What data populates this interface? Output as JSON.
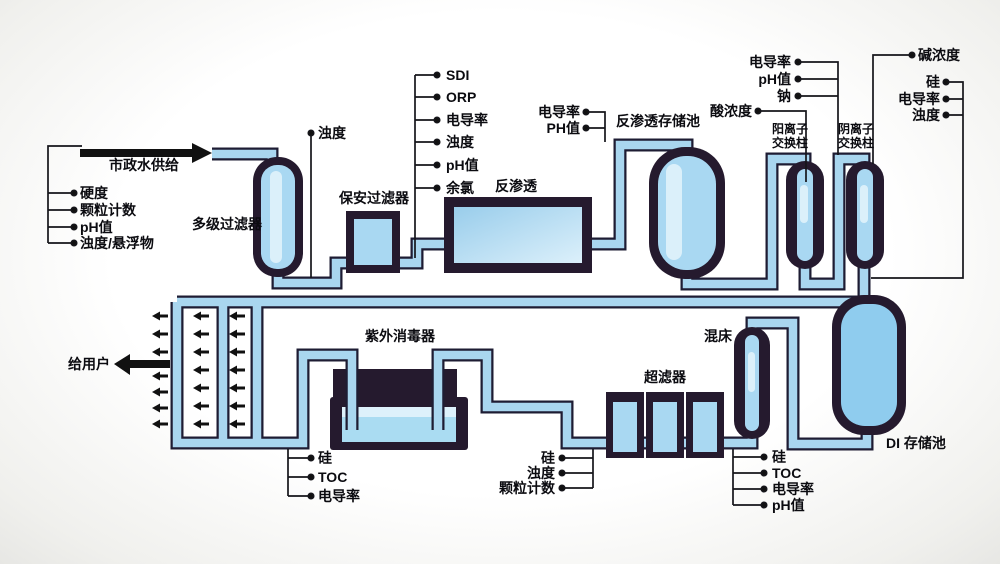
{
  "diagram": {
    "feed_arrow_label": "市政水供给",
    "to_user_label": "给用户",
    "components": {
      "multistage_filter": "多级过滤器",
      "security_filter": "保安过滤器",
      "reverse_osmosis": "反渗透",
      "ro_storage_tank": "反渗透存储池",
      "cation_exchanger_line1": "阳离子",
      "cation_exchanger_line2": "交换柱",
      "anion_exchanger_line1": "阴离子",
      "anion_exchanger_line2": "交换柱",
      "di_storage_tank": "DI 存储池",
      "mixed_bed": "混床",
      "ultrafilter": "超滤器",
      "uv_sterilizer": "紫外消毒器"
    },
    "measurements": {
      "feed_water": [
        "硬度",
        "颗粒计数",
        "pH值",
        "浊度/悬浮物"
      ],
      "after_multistage_filter": [
        "浊度"
      ],
      "before_reverse_osmosis": [
        "SDI",
        "ORP",
        "电导率",
        "浊度",
        "pH值",
        "余氯"
      ],
      "ro_permeate": [
        "电导率",
        "PH值"
      ],
      "acid_concentration": "酸浓度",
      "after_cation_exchanger": [
        "电导率",
        "pH值",
        "钠"
      ],
      "alkali_concentration": "碱浓度",
      "after_anion_exchanger": [
        "硅",
        "电导率",
        "浊度"
      ],
      "after_mixed_bed": [
        "硅",
        "TOC",
        "电导率",
        "pH值"
      ],
      "before_ultrafilter": [
        "硅",
        "浊度",
        "颗粒计数"
      ],
      "after_uv": [
        "硅",
        "TOC",
        "电导率"
      ]
    },
    "colors": {
      "pipe_fill": "#a9d6ef",
      "pipe_outline": "#1e1c33",
      "vessel_dark": "#251a2e",
      "vessel_water": "#a9d8f2",
      "di_tank_water": "#8fccee",
      "line_black": "#141418"
    }
  }
}
